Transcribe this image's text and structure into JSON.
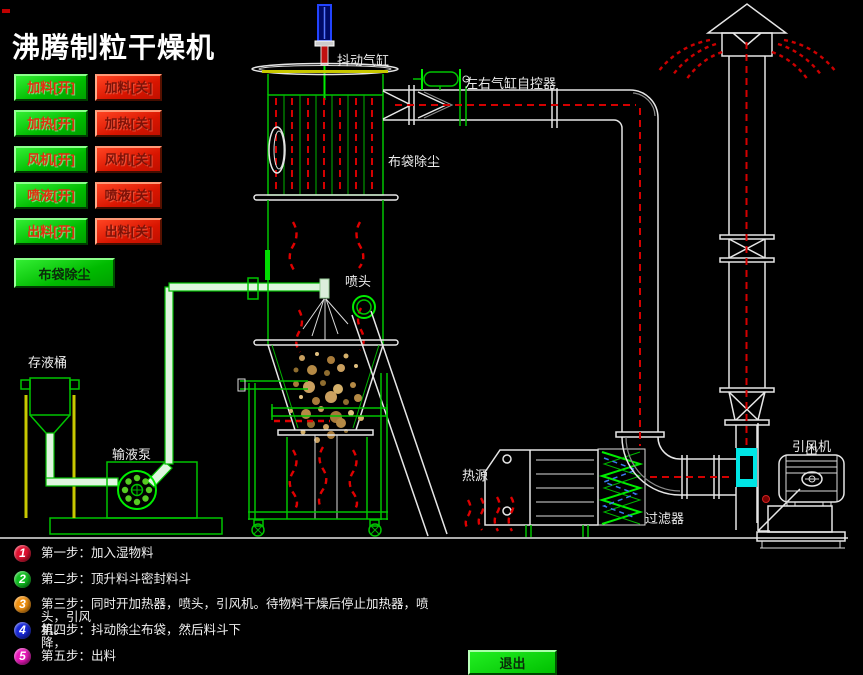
{
  "window": {
    "title": "沸腾制粒干燥机"
  },
  "control_panel": {
    "rows": [
      {
        "on": "加料[开]",
        "off": "加料[关]"
      },
      {
        "on": "加热[开]",
        "off": "加热[关]"
      },
      {
        "on": "风机[开]",
        "off": "风机[关]"
      },
      {
        "on": "喷液[开]",
        "off": "喷液[关]"
      },
      {
        "on": "出料[开]",
        "off": "出料[关]"
      }
    ],
    "bag_dust_button": "布袋除尘"
  },
  "exit_button": "退出",
  "diagram_labels": {
    "shake_cylinder": "抖动气缸",
    "lr_cylinder_controller": "左右气缸自控器",
    "bag_filter": "布袋除尘",
    "spray_head": "喷头",
    "liquid_tank": "存液桶",
    "liquid_pump": "输液泵",
    "heat_source": "热源",
    "filter": "过滤器",
    "induced_fan": "引风机"
  },
  "steps": [
    {
      "num": "1",
      "color": "#e01030",
      "text": "第一步：加入湿物料"
    },
    {
      "num": "2",
      "color": "#10c020",
      "text": "第二步：顶升料斗密封料斗"
    },
    {
      "num": "3",
      "color": "#f09010",
      "text": "第三步：同时开加热器，喷头，引风机。待物料干燥后停止加热器，喷头，引风\n机。"
    },
    {
      "num": "4",
      "color": "#1828d8",
      "text": "第四步：抖动除尘布袋，然后料斗下\n降，"
    },
    {
      "num": "5",
      "color": "#e818b8",
      "text": "第五步：出料"
    }
  ],
  "colors": {
    "background": "#000000",
    "line_green": "#00c400",
    "flow_red": "#d40000",
    "damper_cyan": "#00e6e6",
    "legs_yellow": "#c8c800",
    "button_green": "#00bb00",
    "button_red": "#d81500"
  }
}
